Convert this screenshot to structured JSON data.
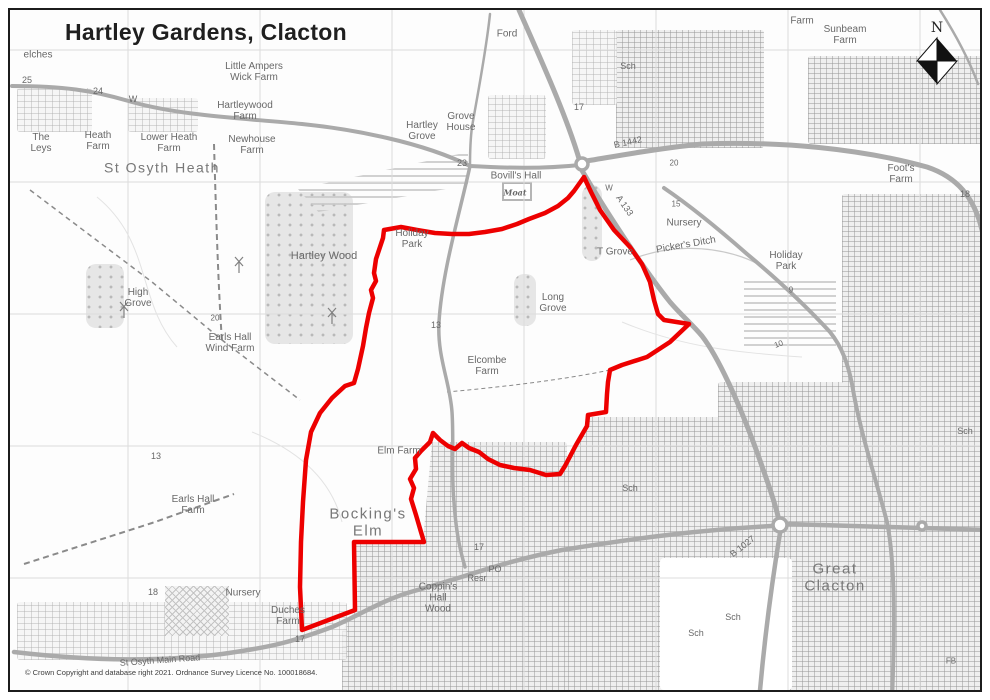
{
  "title": "Hartley Gardens, Clacton",
  "copyright": "© Crown Copyright and database right 2021. Ordnance Survey Licence No. 100018684.",
  "compass": {
    "label": "N"
  },
  "colors": {
    "boundary": "#ed0000",
    "road": "#aaaaaa",
    "grid": "#dcdcdc",
    "contour": "#e3e3e3",
    "stream": "#c9c9c9",
    "dash": "#8a8a8a",
    "label": "#686868"
  },
  "map": {
    "grid": {
      "vertical_x": [
        126,
        258,
        390,
        522,
        654,
        786,
        918
      ],
      "horizontal_y": [
        48,
        180,
        312,
        444,
        576
      ]
    },
    "boundary": {
      "width": 4.5,
      "points": "582,175 589,190 598,208 612,228 628,245 640,262 648,280 652,298 656,312 662,318 687,322 668,340 645,355 620,363 608,368 606,380 605,392 604,410 586,413 585,424 574,443 563,464 558,472 544,473 528,468 512,466 498,463 486,457 477,450 467,446 460,441 453,447 446,444 438,438 431,431 428,440 419,449 413,456 414,467 408,477 412,486 409,497 414,513 419,530 422,540 352,540 353,608 300,628 298,585 299,540 301,500 304,458 309,430 318,411 330,396 343,384 352,381 356,367 361,344 364,326 367,311 371,296 369,288 374,279 372,271 374,257 381,236 382,228 399,225 415,228 433,231 450,232 467,232 483,230 500,227 515,222 527,217 543,211 556,204 566,196 572,189 577,182"
    },
    "roads": [
      {
        "d": "M517,8 C540,60 565,115 578,160",
        "w": 5
      },
      {
        "d": "M578,160 C610,155 650,147 700,142 C780,139 860,147 925,165 C955,175 972,195 980,228",
        "w": 5
      },
      {
        "d": "M578,163 C540,167 505,166 468,164",
        "w": 4
      },
      {
        "d": "M578,165 C600,203 640,265 668,300 C680,314 690,322 700,334 C720,360 745,420 762,470 C770,492 775,508 778,523",
        "w": 5
      },
      {
        "d": "M662,186 C690,205 720,230 745,252 C775,277 805,305 828,330 C840,345 846,362 850,382 C858,430 872,470 885,520 C893,560 893,620 890,700",
        "w": 4
      },
      {
        "d": "M12,650 C80,658 150,661 220,652 C270,645 290,640 330,625 C360,612 380,598 412,589 C470,573 500,560 560,548 C640,535 700,528 770,524",
        "w": 4.5
      },
      {
        "d": "M786,522 L985,528",
        "w": 4.5
      },
      {
        "d": "M778,531 C770,580 762,640 757,700",
        "w": 4.5
      },
      {
        "d": "M468,164 C458,210 440,270 437,320 C435,355 448,380 450,410 C452,440 449,470 452,500 C454,530 458,548 463,565",
        "w": 3.5
      },
      {
        "d": "M10,84 C60,84 90,88 130,100 C180,114 240,116 300,122 C350,127 420,140 468,164",
        "w": 4
      },
      {
        "d": "M488,12 C484,50 476,90 470,125 C468,140 468,152 468,164",
        "w": 2.5
      },
      {
        "d": "M938,8 C952,30 966,55 976,82",
        "w": 2.5
      }
    ],
    "roundabouts": [
      [
        580,
        162,
        6
      ],
      [
        778,
        523,
        7
      ],
      [
        920,
        524,
        4
      ]
    ],
    "contours": [
      {
        "d": "M95,195 C150,240 135,300 175,345"
      },
      {
        "d": "M620,320 C680,345 730,350 800,355"
      },
      {
        "d": "M250,430 C300,450 330,480 340,520"
      }
    ],
    "streams": [
      {
        "d": "M628,258 C665,243 705,243 740,255 C760,262 772,272 780,282"
      }
    ],
    "dashes": [
      {
        "d": "M28,188 L150,280 220,338 298,398",
        "w": 1.5,
        "dash": "5,4"
      },
      {
        "d": "M212,142 C214,210 216,280 220,340",
        "w": 2,
        "dash": "6,4"
      },
      {
        "d": "M22,562 L150,521 232,492",
        "w": 2,
        "dash": "6,4"
      },
      {
        "d": "M608,368 C560,378 500,385 445,390",
        "w": 1,
        "dash": "4,3"
      }
    ],
    "turbines": [
      [
        122,
        316
      ],
      [
        237,
        271
      ],
      [
        330,
        322
      ]
    ],
    "patches": [
      {
        "type": "urban",
        "x": 614,
        "y": 28,
        "w": 148,
        "h": 118
      },
      {
        "type": "urban-light",
        "x": 570,
        "y": 28,
        "w": 45,
        "h": 75
      },
      {
        "type": "urban",
        "x": 806,
        "y": 54,
        "w": 179,
        "h": 88
      },
      {
        "type": "urban",
        "x": 840,
        "y": 192,
        "w": 145,
        "h": 508
      },
      {
        "type": "urban",
        "x": 716,
        "y": 380,
        "w": 126,
        "h": 320
      },
      {
        "type": "urban",
        "x": 560,
        "y": 415,
        "w": 172,
        "h": 285,
        "clip": "polygon(16% 0%, 100% 0%, 100% 100%, 0% 100%, 0% 20%)"
      },
      {
        "type": "urban",
        "x": 340,
        "y": 440,
        "w": 225,
        "h": 260,
        "clip": "polygon(40% 0%, 100% 0%, 100% 100%, 0% 100%, 0% 73%, 6% 64%, 6% 38%, 36% 38%)"
      },
      {
        "type": "urban-light",
        "x": 15,
        "y": 600,
        "w": 330,
        "h": 58
      },
      {
        "type": "urban-light",
        "x": 15,
        "y": 86,
        "w": 75,
        "h": 44
      },
      {
        "type": "urban-light",
        "x": 126,
        "y": 96,
        "w": 70,
        "h": 34
      },
      {
        "type": "urban-light",
        "x": 486,
        "y": 93,
        "w": 58,
        "h": 64
      },
      {
        "type": "white",
        "x": 658,
        "y": 556,
        "w": 132,
        "h": 132
      },
      {
        "type": "wood",
        "x": 263,
        "y": 190,
        "w": 88,
        "h": 152
      },
      {
        "type": "wood",
        "x": 84,
        "y": 262,
        "w": 38,
        "h": 64
      },
      {
        "type": "wood",
        "x": 580,
        "y": 183,
        "w": 20,
        "h": 76
      },
      {
        "type": "wood",
        "x": 512,
        "y": 272,
        "w": 22,
        "h": 52
      },
      {
        "type": "caravan",
        "x": 296,
        "y": 150,
        "w": 170,
        "h": 60,
        "clip": "polygon(0% 62%, 100% 0%, 100% 55%, 12% 100%)"
      },
      {
        "type": "caravan",
        "x": 742,
        "y": 278,
        "w": 92,
        "h": 66
      },
      {
        "type": "crosshatch",
        "x": 163,
        "y": 584,
        "w": 64,
        "h": 50
      },
      {
        "type": "moat",
        "x": 500,
        "y": 180,
        "w": 26,
        "h": 15
      }
    ],
    "labels": [
      {
        "t": "elches",
        "x": 36,
        "y": 53,
        "s": 10
      },
      {
        "t": "25",
        "x": 25,
        "y": 79,
        "s": 9
      },
      {
        "t": "24",
        "x": 96,
        "y": 90,
        "s": 9
      },
      {
        "t": "W",
        "x": 131,
        "y": 98,
        "s": 9
      },
      {
        "t": "Little Ampers\nWick Farm",
        "x": 252,
        "y": 70,
        "s": 10
      },
      {
        "t": "Hartleywood\nFarm",
        "x": 243,
        "y": 109,
        "s": 10
      },
      {
        "t": "The\nLeys",
        "x": 39,
        "y": 141,
        "s": 10
      },
      {
        "t": "Heath\nFarm",
        "x": 96,
        "y": 139,
        "s": 10
      },
      {
        "t": "Lower Heath\nFarm",
        "x": 167,
        "y": 141,
        "s": 10
      },
      {
        "t": "Newhouse\nFarm",
        "x": 250,
        "y": 143,
        "s": 10
      },
      {
        "t": "St Osyth Heath",
        "x": 160,
        "y": 166,
        "s": 14,
        "big": true
      },
      {
        "t": "Ford",
        "x": 505,
        "y": 32,
        "s": 10
      },
      {
        "t": "Hartley\nGrove",
        "x": 420,
        "y": 129,
        "s": 10
      },
      {
        "t": "Grove\nHouse",
        "x": 459,
        "y": 120,
        "s": 10
      },
      {
        "t": "Sch",
        "x": 626,
        "y": 65,
        "s": 9
      },
      {
        "t": "17",
        "x": 577,
        "y": 106,
        "s": 9
      },
      {
        "t": "B 1442",
        "x": 626,
        "y": 141,
        "s": 9,
        "r": -12
      },
      {
        "t": "20",
        "x": 672,
        "y": 162,
        "s": 8
      },
      {
        "t": "Farm",
        "x": 800,
        "y": 19,
        "s": 10
      },
      {
        "t": "Sunbeam\nFarm",
        "x": 843,
        "y": 33,
        "s": 10
      },
      {
        "t": "Foot's\nFarm",
        "x": 899,
        "y": 172,
        "s": 10
      },
      {
        "t": "23",
        "x": 460,
        "y": 162,
        "s": 9
      },
      {
        "t": "Bovill's Hall",
        "x": 514,
        "y": 174,
        "s": 10
      },
      {
        "t": "Moat",
        "x": 513,
        "y": 191,
        "s": 8,
        "serif": true
      },
      {
        "t": "W",
        "x": 607,
        "y": 187,
        "s": 8
      },
      {
        "t": "A 133",
        "x": 622,
        "y": 204,
        "s": 9,
        "r": 55
      },
      {
        "t": "15",
        "x": 674,
        "y": 203,
        "s": 8
      },
      {
        "t": "Nursery",
        "x": 682,
        "y": 221,
        "s": 10
      },
      {
        "t": "Picker's Ditch",
        "x": 684,
        "y": 243,
        "s": 10,
        "r": -10
      },
      {
        "t": "Holiday\nPark",
        "x": 784,
        "y": 259,
        "s": 10
      },
      {
        "t": "Holiday\nPark",
        "x": 410,
        "y": 237,
        "s": 10
      },
      {
        "t": "T Grove",
        "x": 613,
        "y": 250,
        "s": 10
      },
      {
        "t": "Hartley Wood",
        "x": 322,
        "y": 254,
        "s": 11
      },
      {
        "t": "Long\nGrove",
        "x": 551,
        "y": 301,
        "s": 10
      },
      {
        "t": "High\nGrove",
        "x": 136,
        "y": 296,
        "s": 10
      },
      {
        "t": "20",
        "x": 213,
        "y": 317,
        "s": 8
      },
      {
        "t": "Earls Hall\nWind Farm",
        "x": 228,
        "y": 341,
        "s": 10
      },
      {
        "t": "9",
        "x": 789,
        "y": 289,
        "s": 8
      },
      {
        "t": "10",
        "x": 777,
        "y": 343,
        "s": 8,
        "r": -20
      },
      {
        "t": "13",
        "x": 434,
        "y": 324,
        "s": 9
      },
      {
        "t": "Elcombe\nFarm",
        "x": 485,
        "y": 364,
        "s": 10
      },
      {
        "t": "18",
        "x": 963,
        "y": 193,
        "s": 9
      },
      {
        "t": "13",
        "x": 154,
        "y": 455,
        "s": 9
      },
      {
        "t": "Earls Hall\nFarm",
        "x": 191,
        "y": 503,
        "s": 10
      },
      {
        "t": "Elm Farm",
        "x": 397,
        "y": 449,
        "s": 10
      },
      {
        "t": "Bocking's\nElm",
        "x": 366,
        "y": 521,
        "s": 15,
        "big": true
      },
      {
        "t": "Sch",
        "x": 628,
        "y": 487,
        "s": 9
      },
      {
        "t": "Sch",
        "x": 963,
        "y": 430,
        "s": 9
      },
      {
        "t": "17",
        "x": 477,
        "y": 546,
        "s": 9
      },
      {
        "t": "B 1027",
        "x": 741,
        "y": 545,
        "s": 9,
        "r": -38
      },
      {
        "t": "PO",
        "x": 493,
        "y": 568,
        "s": 9
      },
      {
        "t": "Resr",
        "x": 475,
        "y": 577,
        "s": 9
      },
      {
        "t": "Great\nClacton",
        "x": 833,
        "y": 576,
        "s": 15,
        "big": true
      },
      {
        "t": "Coppin's\nHall\nWood",
        "x": 436,
        "y": 596,
        "s": 10
      },
      {
        "t": "Nursery",
        "x": 241,
        "y": 591,
        "s": 10
      },
      {
        "t": "18",
        "x": 151,
        "y": 591,
        "s": 9
      },
      {
        "t": "Duches\nFarm",
        "x": 286,
        "y": 614,
        "s": 10
      },
      {
        "t": "17",
        "x": 298,
        "y": 638,
        "s": 9
      },
      {
        "t": "St Osyth Main Road",
        "x": 158,
        "y": 659,
        "s": 9,
        "r": -4
      },
      {
        "t": "Sch",
        "x": 731,
        "y": 616,
        "s": 9
      },
      {
        "t": "Sch",
        "x": 694,
        "y": 632,
        "s": 9
      },
      {
        "t": "FB",
        "x": 949,
        "y": 660,
        "s": 8
      }
    ]
  }
}
